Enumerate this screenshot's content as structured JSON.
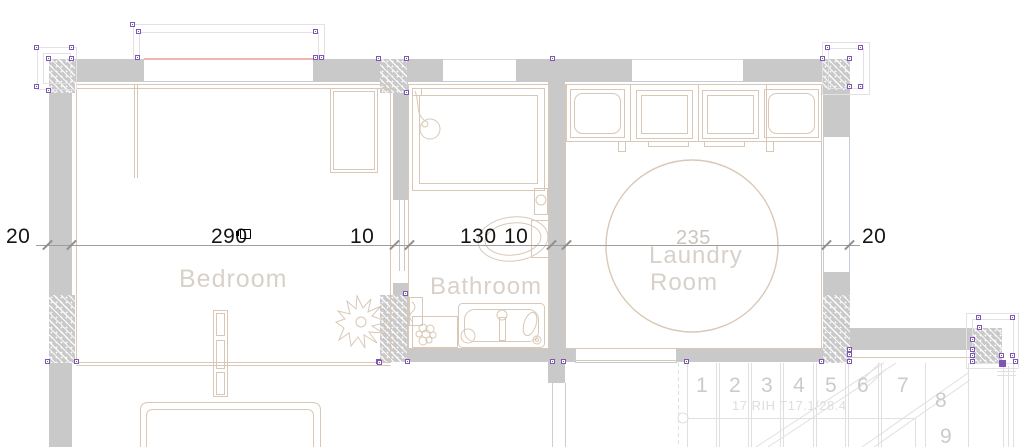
{
  "plan": {
    "rooms": {
      "bedroom": "Bedroom",
      "bathroom": "Bathroom",
      "laundry1": "Laundry",
      "laundry2": "Room"
    },
    "dimensions": {
      "wall_left": "20",
      "bedroom_width": "290",
      "gap1": "10",
      "bathroom_width": "130",
      "gap2": "10",
      "laundry_width": "235",
      "wall_right": "20"
    },
    "stairs": {
      "steps": [
        "1",
        "2",
        "3",
        "4",
        "5",
        "6",
        "7",
        "8",
        "9"
      ],
      "annotation": "17 RIH T17.1/28.4"
    },
    "colors": {
      "wall": "#c9c9c9",
      "line_tan": "#d9c8b7",
      "label_gray": "#d8d1ca",
      "window_blue": "#c3cdd9",
      "selected_pink": "#f0b4b4",
      "handle_purple": "#7e57b5"
    }
  }
}
